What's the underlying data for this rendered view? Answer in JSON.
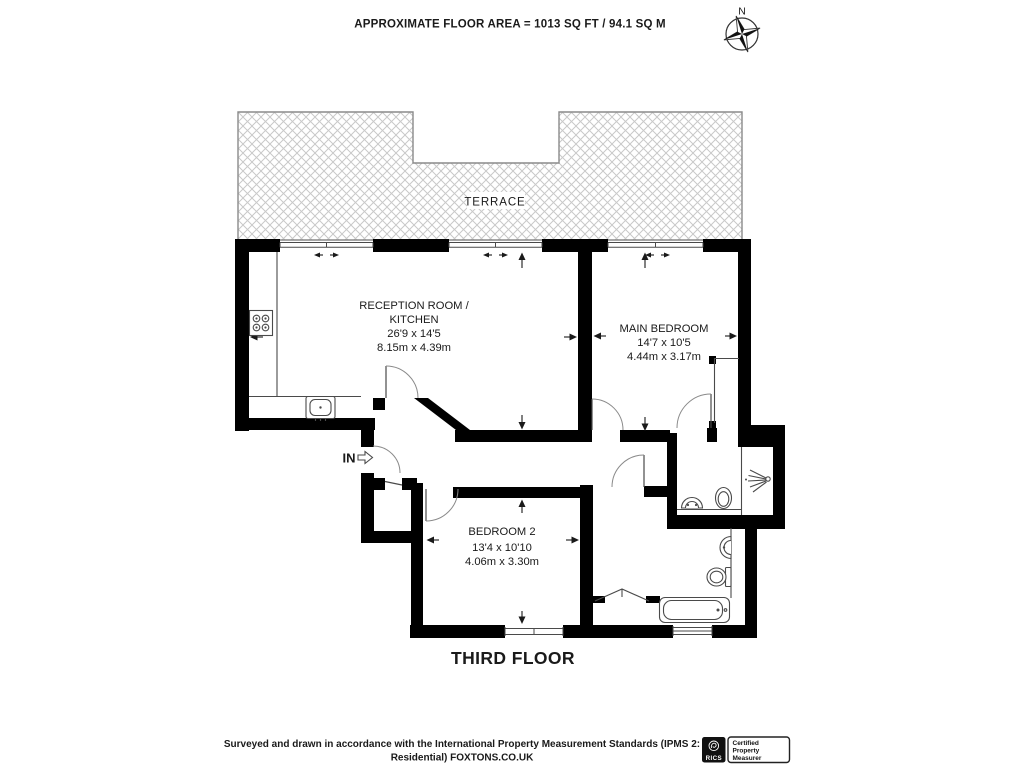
{
  "header": {
    "title": "APPROXIMATE FLOOR AREA = 1013 SQ FT / 94.1 SQ M"
  },
  "compass": {
    "north_label": "N"
  },
  "plan": {
    "terrace_label": "TERRACE",
    "entry_label": "IN",
    "floor_label": "THIRD FLOOR",
    "rooms": {
      "reception": {
        "name_line1": "RECEPTION ROOM /",
        "name_line2": "KITCHEN",
        "size_imperial": "26'9 x 14'5",
        "size_metric": "8.15m x 4.39m"
      },
      "main_bedroom": {
        "name": "MAIN BEDROOM",
        "size_imperial": "14'7 x 10'5",
        "size_metric": "4.44m x 3.17m"
      },
      "bedroom_2": {
        "name": "BEDROOM 2",
        "size_imperial": "13'4 x 10'10",
        "size_metric": "4.06m x 3.30m"
      }
    }
  },
  "footer": {
    "disclaimer_line1": "Surveyed and drawn in accordance with the International Property Measurement Standards (IPMS 2:",
    "disclaimer_line2": "Residential) FOXTONS.CO.UK"
  },
  "badge": {
    "org": "RICS",
    "title_line1": "Certified",
    "title_line2": "Property",
    "title_line3": "Measurer"
  },
  "colors": {
    "wall": "#000000",
    "thin_line": "#4a4a4a",
    "hatch": "#c9c9c9",
    "background": "#ffffff"
  }
}
